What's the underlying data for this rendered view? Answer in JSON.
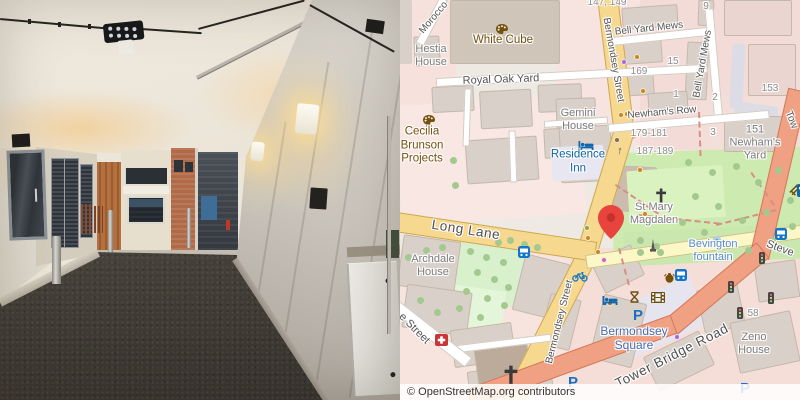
{
  "photo": {
    "alt": "Covered alley passage with concrete walls, louvered doors, ceiling floodlight and a courtyard with brick buildings",
    "colors": {
      "ceiling": "#eae3d6",
      "right_wall": "#c9c4bb",
      "left_wall": "#d9d2c4",
      "floor": "#4a453f",
      "brick": "#b06a48",
      "wood_fence": "#b5713d"
    }
  },
  "map": {
    "attribution": "© OpenStreetMap.org contributors",
    "colors": {
      "sec": "#f6d88e",
      "sec_c": "#cda855",
      "ter": "#fbf7c6",
      "ter_c": "#cbc489",
      "trunk": "#f0a183",
      "trunk_c": "#d3795a",
      "white": "#ffffff",
      "white_c": "#d2cbc2",
      "building": "#d9d0c9",
      "building_stroke": "#c5b8aa",
      "park": "#cdebb0",
      "pedestrian": "#dcdce6",
      "marker": "#e8433c",
      "poi_brown": "#74500f",
      "poi_blue": "#1266a9",
      "path": "#d98d85",
      "tree": "#a3c98f"
    },
    "zones": [
      [
        398,
        0,
        58,
        118,
        0,
        "#f6e1dd"
      ],
      [
        398,
        100,
        185,
        120,
        -4,
        "#f8e7e3"
      ],
      [
        556,
        0,
        90,
        145,
        0,
        "#f7e3df"
      ],
      [
        640,
        0,
        160,
        150,
        0,
        "#f3dcd7"
      ],
      [
        398,
        252,
        210,
        148,
        0,
        "#f7e4df"
      ],
      [
        570,
        248,
        230,
        152,
        0,
        "#f5ded8"
      ],
      [
        700,
        96,
        100,
        62,
        0,
        "#f4ded9"
      ],
      [
        612,
        150,
        192,
        112,
        -2,
        "#cdebb0"
      ],
      [
        624,
        228,
        176,
        34,
        -3,
        "#c9e7ae"
      ],
      [
        453,
        233,
        70,
        70,
        8,
        "#d9f0cc"
      ],
      [
        450,
        288,
        54,
        40,
        8,
        "#e4f6da"
      ],
      [
        604,
        294,
        100,
        52,
        -25,
        "#e6e4ee"
      ],
      [
        731,
        44,
        13,
        64,
        3,
        "#dcdce6"
      ],
      [
        734,
        104,
        44,
        13,
        8,
        "#dcdce6"
      ],
      [
        398,
        0,
        14,
        64,
        0,
        "#d9d0c9"
      ]
    ],
    "buildings": [
      [
        450,
        0,
        110,
        64,
        0,
        "#cfc5b9"
      ],
      [
        414,
        36,
        26,
        30,
        -3
      ],
      [
        432,
        86,
        42,
        26,
        -3
      ],
      [
        480,
        90,
        52,
        38,
        -3
      ],
      [
        538,
        84,
        44,
        28,
        -2
      ],
      [
        466,
        138,
        72,
        44,
        -4
      ],
      [
        544,
        128,
        34,
        30,
        -3
      ],
      [
        556,
        98,
        40,
        30,
        -2
      ],
      [
        610,
        36,
        52,
        28,
        -4
      ],
      [
        614,
        70,
        40,
        26,
        -4
      ],
      [
        686,
        42,
        22,
        58,
        3
      ],
      [
        648,
        92,
        40,
        22,
        -4
      ],
      [
        622,
        6,
        56,
        22,
        -4
      ],
      [
        698,
        0,
        16,
        26,
        2
      ],
      [
        724,
        0,
        68,
        36,
        0,
        "#ead5d0"
      ],
      [
        748,
        44,
        48,
        52,
        0,
        "#ead5d0"
      ],
      [
        724,
        116,
        64,
        36,
        0
      ],
      [
        606,
        166,
        50,
        46,
        3,
        "#cbbcae"
      ],
      [
        560,
        126,
        52,
        56,
        -3
      ],
      [
        400,
        238,
        58,
        52,
        8
      ],
      [
        404,
        288,
        66,
        44,
        8
      ],
      [
        518,
        258,
        46,
        58,
        14
      ],
      [
        452,
        326,
        62,
        38,
        -8
      ],
      [
        468,
        366,
        84,
        26,
        -8
      ],
      [
        476,
        342,
        54,
        46,
        -8,
        "#bcab9a"
      ],
      [
        544,
        296,
        32,
        52,
        14
      ],
      [
        596,
        252,
        44,
        34,
        -26
      ],
      [
        596,
        298,
        44,
        66,
        14
      ],
      [
        648,
        342,
        62,
        38,
        -26
      ],
      [
        700,
        286,
        42,
        44,
        -12
      ],
      [
        734,
        316,
        62,
        52,
        -12
      ],
      [
        756,
        262,
        42,
        38,
        -8
      ]
    ],
    "overlays": [
      [
        552,
        146,
        52,
        34,
        -3,
        "#e8e6f0"
      ],
      [
        628,
        168,
        96,
        52,
        -4,
        "#d9f2c0"
      ]
    ],
    "roads": [
      [
        607,
        -8,
        148,
        21,
        83,
        "sec"
      ],
      [
        625,
        128,
        136,
        21,
        107,
        "sec"
      ],
      [
        588,
        253,
        168,
        21,
        117,
        "sec"
      ],
      [
        396,
        222,
        202,
        20,
        8.5,
        "sec"
      ],
      [
        586,
        262,
        218,
        14,
        -8,
        "ter"
      ],
      [
        798,
        90,
        172,
        20,
        103,
        "trunk"
      ],
      [
        763,
        250,
        122,
        20,
        140,
        "trunk"
      ],
      [
        674,
        324,
        218,
        20,
        160,
        "trunk"
      ],
      [
        436,
        82,
        272,
        9,
        -3,
        "white"
      ],
      [
        612,
        41,
        98,
        9,
        -6,
        "white"
      ],
      [
        709,
        8,
        114,
        9,
        85,
        "white"
      ],
      [
        608,
        128,
        162,
        9,
        -5,
        "white"
      ],
      [
        444,
        -2,
        52,
        9,
        118,
        "white"
      ],
      [
        450,
        350,
        102,
        8,
        -7,
        "white"
      ],
      [
        396,
        306,
        92,
        12,
        38,
        "white"
      ],
      [
        544,
        124,
        64,
        7,
        -4,
        "white"
      ],
      [
        468,
        88,
        58,
        7,
        92,
        "white"
      ],
      [
        512,
        130,
        52,
        7,
        88,
        "white"
      ]
    ],
    "paths": [
      [
        616,
        184,
        52,
        34
      ],
      [
        638,
        214,
        82,
        6
      ],
      [
        716,
        224,
        62,
        -14
      ],
      [
        700,
        112,
        44,
        88
      ],
      [
        752,
        172,
        40,
        55
      ],
      [
        620,
        248,
        38,
        75
      ]
    ],
    "trees": [
      [
        688,
        162
      ],
      [
        712,
        172
      ],
      [
        736,
        166
      ],
      [
        758,
        182
      ],
      [
        778,
        170
      ],
      [
        695,
        196
      ],
      [
        718,
        206
      ],
      [
        742,
        220
      ],
      [
        766,
        212
      ],
      [
        790,
        200
      ],
      [
        682,
        222
      ],
      [
        704,
        232
      ],
      [
        726,
        244
      ],
      [
        748,
        250
      ],
      [
        772,
        240
      ],
      [
        660,
        252
      ],
      [
        640,
        252
      ],
      [
        792,
        226
      ],
      [
        498,
        242
      ],
      [
        510,
        240
      ],
      [
        524,
        244
      ],
      [
        537,
        247
      ],
      [
        470,
        251
      ],
      [
        486,
        257
      ],
      [
        503,
        262
      ],
      [
        477,
        272
      ],
      [
        494,
        279
      ],
      [
        508,
        287
      ],
      [
        466,
        291
      ],
      [
        487,
        298
      ],
      [
        504,
        305
      ],
      [
        459,
        308
      ],
      [
        480,
        317
      ],
      [
        426,
        250
      ],
      [
        408,
        257
      ],
      [
        442,
        247
      ],
      [
        420,
        300
      ],
      [
        437,
        312
      ],
      [
        453,
        160
      ],
      [
        455,
        185
      ],
      [
        640,
        240
      ],
      [
        656,
        246
      ]
    ],
    "poi_dots": [
      [
        624,
        62,
        "#a86ad4"
      ],
      [
        637,
        57,
        "#c8871c"
      ],
      [
        643,
        91,
        "#c8871c"
      ],
      [
        617,
        140,
        "#8a6d3b"
      ],
      [
        640,
        170,
        "#c8871c"
      ],
      [
        645,
        214,
        "#c8871c"
      ],
      [
        588,
        238,
        "#c8871c"
      ],
      [
        587,
        228,
        "#9aa33b"
      ],
      [
        610,
        303,
        "#8a6d3b"
      ],
      [
        677,
        337,
        "#a86ad4"
      ],
      [
        621,
        115,
        "#c8871c"
      ],
      [
        627,
        114,
        "#c8871c"
      ],
      [
        598,
        252,
        "#c8871c"
      ],
      [
        604,
        260,
        "#d46aa8"
      ]
    ],
    "icons": [
      [
        "palette-icon",
        495,
        23,
        0,
        1
      ],
      [
        "palette-icon",
        422,
        114,
        0,
        1
      ],
      [
        "hotel-bed-icon",
        578,
        140,
        0,
        1
      ],
      [
        "hotel-bed-icon",
        602,
        295,
        0,
        1
      ],
      [
        "church-cross-icon",
        655,
        188,
        0,
        1
      ],
      [
        "church-cross-icon",
        503,
        365,
        0,
        1.3
      ],
      [
        "parking-icon",
        638,
        316,
        0,
        1
      ],
      [
        "parking-icon",
        573,
        383,
        0,
        1
      ],
      [
        "parking-icon",
        745,
        389,
        0,
        1
      ],
      [
        "bus-stop-icon",
        518,
        246,
        0,
        1
      ],
      [
        "bus-stop-icon",
        675,
        269,
        0,
        1
      ],
      [
        "bus-stop-icon",
        775,
        228,
        0,
        1
      ],
      [
        "bicycle-rental-icon",
        572,
        271,
        0,
        1
      ],
      [
        "first-aid-icon",
        435,
        334,
        0,
        1
      ],
      [
        "cinema-icon",
        651,
        292,
        0,
        1
      ],
      [
        "hourglass-icon",
        629,
        290,
        0,
        1
      ],
      [
        "amphora-icon",
        664,
        271,
        0,
        1
      ],
      [
        "traffic-signal-icon",
        728,
        281,
        0,
        1
      ],
      [
        "traffic-signal-icon",
        759,
        252,
        0,
        1
      ],
      [
        "traffic-signal-icon",
        768,
        292,
        0,
        1
      ],
      [
        "traffic-signal-icon",
        737,
        307,
        0,
        1
      ],
      [
        "fountain-icon",
        712,
        236,
        0,
        1
      ],
      [
        "monument-icon",
        649,
        239,
        0,
        1
      ],
      [
        "bench-icon",
        787,
        191,
        -45,
        1
      ],
      [
        "oneway-arrow-icon",
        620,
        150,
        5,
        1
      ],
      [
        "transit-stop-icon",
        797,
        184,
        0,
        1
      ]
    ],
    "labels": [
      [
        "Morocco",
        434,
        18,
        -50,
        "st"
      ],
      [
        "Bell Yard Mews",
        649,
        29,
        -6,
        "st"
      ],
      [
        "Bell Yard Mews",
        703,
        64,
        -80,
        "st"
      ],
      [
        "Bermondsey Street",
        613,
        60,
        80,
        "st"
      ],
      [
        "Bermondsey Street",
        560,
        322,
        -76,
        "st"
      ],
      [
        "Newham's Row",
        662,
        113,
        -5,
        "st"
      ],
      [
        "Royal Oak Yard",
        501,
        80,
        -2,
        "st2"
      ],
      [
        "Long Lane",
        466,
        230,
        9,
        "st3"
      ],
      [
        "Tower Bridge Road",
        672,
        356,
        -27,
        "st3"
      ],
      [
        "Tow",
        791,
        120,
        68,
        "st"
      ],
      [
        "Steve",
        780,
        249,
        20,
        "st2"
      ],
      [
        "e Street",
        414,
        329,
        45,
        "st2"
      ],
      [
        "147, 149",
        607,
        3,
        0,
        "num"
      ],
      [
        "9",
        706,
        7,
        0,
        "num"
      ],
      [
        "15",
        673,
        62,
        0,
        "num"
      ],
      [
        "169",
        639,
        72,
        0,
        "num"
      ],
      [
        "1",
        676,
        95,
        0,
        "num"
      ],
      [
        "2",
        715,
        98,
        0,
        "num"
      ],
      [
        "153",
        770,
        89,
        0,
        "num"
      ],
      [
        "3",
        713,
        133,
        0,
        "num"
      ],
      [
        "179-181",
        649,
        134,
        0,
        "num"
      ],
      [
        "187-189",
        655,
        152,
        0,
        "num"
      ],
      [
        "58",
        753,
        314,
        0,
        "num"
      ],
      [
        "Hestia\nHouse",
        431,
        56,
        0,
        "nm"
      ],
      [
        "Gemini\nHouse",
        578,
        120,
        0,
        "nm"
      ],
      [
        "Archdale\nHouse",
        433,
        266,
        0,
        "nm"
      ],
      [
        "Zeno\nHouse",
        754,
        344,
        0,
        "nm"
      ],
      [
        "151\nNewham's\nYard",
        755,
        143,
        0,
        "nm"
      ],
      [
        "St Mary\nMagdalen",
        654,
        214,
        0,
        "nm"
      ],
      [
        "White Cube",
        503,
        41,
        0,
        "brown"
      ],
      [
        "Cecilia\nBrunson\nProjects",
        422,
        146,
        0,
        "brown"
      ],
      [
        "Residence\nInn",
        578,
        162,
        0,
        "tour"
      ],
      [
        "Bermondsey\nSquare",
        634,
        338,
        0,
        "place"
      ],
      [
        "Bevington\nfountain",
        713,
        251,
        0,
        "water"
      ]
    ],
    "marker": {
      "x": 598,
      "y": 205
    }
  }
}
